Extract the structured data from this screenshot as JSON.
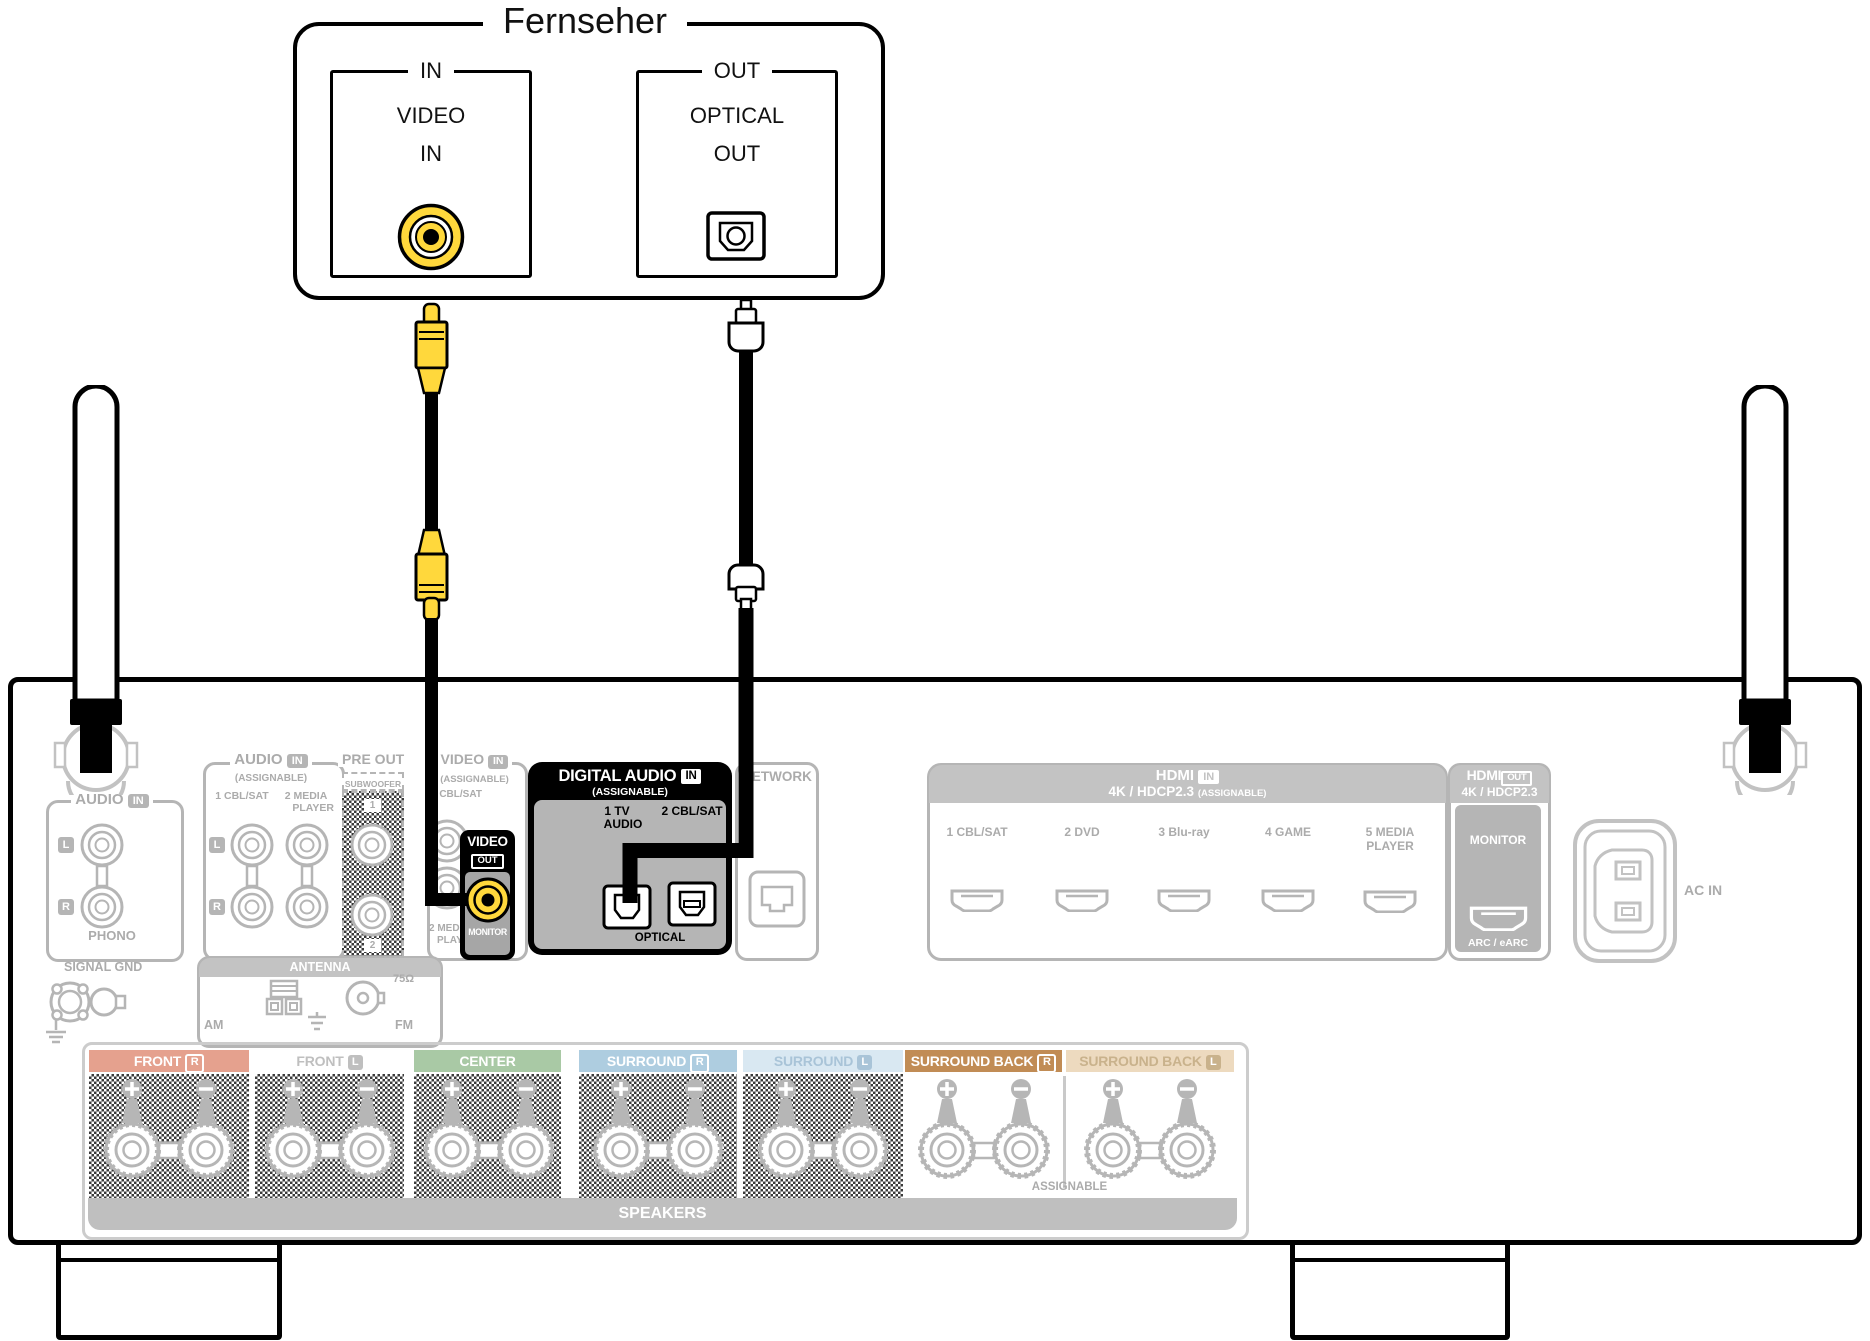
{
  "colors": {
    "accent_yellow": "#FFD83C"
  },
  "tv": {
    "title": "Fernseher",
    "video_in": {
      "box_label": "IN",
      "line1": "VIDEO",
      "line2": "IN"
    },
    "optical_out": {
      "box_label": "OUT",
      "line1": "OPTICAL",
      "line2": "OUT"
    }
  },
  "receiver": {
    "phono": {
      "label": "AUDIO",
      "badge": "IN",
      "left": "L",
      "right": "R",
      "caption": "PHONO"
    },
    "audio_in": {
      "label": "AUDIO",
      "badge": "IN",
      "sub": "(ASSIGNABLE)",
      "col1": "1 CBL/SAT",
      "col2a": "2 MEDIA",
      "col2b": "PLAYER",
      "left": "L",
      "right": "R"
    },
    "pre_out": {
      "label": "PRE OUT",
      "sub": "SUBWOOFER",
      "jack1": "1",
      "jack2": "2"
    },
    "video": {
      "label": "VIDEO",
      "badge": "IN",
      "sub": "(ASSIGNABLE)",
      "in1": "1 CBL/SAT",
      "in2a": "2 MEDIA",
      "in2b": "PLAYER",
      "out_label": "VIDEO",
      "out_badge": "OUT",
      "monitor": "MONITOR"
    },
    "digital": {
      "label": "DIGITAL AUDIO",
      "badge": "IN",
      "sub": "(ASSIGNABLE)",
      "jack1a": "1  TV",
      "jack1b": "AUDIO",
      "jack2": "2 CBL/SAT",
      "caption": "OPTICAL"
    },
    "network": {
      "label": "NETWORK"
    },
    "hdmi_in": {
      "label": "HDMI",
      "badge": "IN",
      "line2": "4K / HDCP2.3",
      "sub": "(ASSIGNABLE)",
      "ports": [
        {
          "label": "1 CBL/SAT"
        },
        {
          "label": "2 DVD"
        },
        {
          "label": "3 Blu-ray"
        },
        {
          "label": "4 GAME"
        },
        {
          "label": "5 MEDIA",
          "label2": "PLAYER"
        }
      ]
    },
    "hdmi_out": {
      "label": "HDMI",
      "badge": "OUT",
      "line2": "4K / HDCP2.3",
      "monitor": "MONITOR",
      "arc": "ARC / eARC"
    },
    "ac_in": {
      "label": "AC IN"
    },
    "signal_gnd": {
      "label": "SIGNAL GND"
    },
    "antenna": {
      "label": "ANTENNA",
      "am": "AM",
      "fm": "FM",
      "ohm": "75Ω"
    },
    "speakers": {
      "bar": "SPEAKERS",
      "assignable": "ASSIGNABLE",
      "groups": [
        {
          "label": "FRONT",
          "letter": "R",
          "bg": "#E5A18E",
          "fg": "#FFFFFF",
          "checker": true
        },
        {
          "label": "FRONT",
          "letter": "L",
          "bg": "#FFFFFF",
          "fg": "#BFBFBF",
          "checker": true
        },
        {
          "label": "CENTER",
          "letter": "",
          "bg": "#A9C9A5",
          "fg": "#FFFFFF",
          "checker": true
        },
        {
          "label": "SURROUND",
          "letter": "R",
          "bg": "#AECDE0",
          "fg": "#FFFFFF",
          "checker": true
        },
        {
          "label": "SURROUND",
          "letter": "L",
          "bg": "#D9E8F2",
          "fg": "#A9C4D8",
          "checker": true
        },
        {
          "label": "SURROUND BACK",
          "letter": "R",
          "bg": "#C18C55",
          "fg": "#FFFFFF",
          "checker": false
        },
        {
          "label": "SURROUND BACK",
          "letter": "L",
          "bg": "#EDDABF",
          "fg": "#C9B28C",
          "checker": false
        }
      ]
    }
  }
}
